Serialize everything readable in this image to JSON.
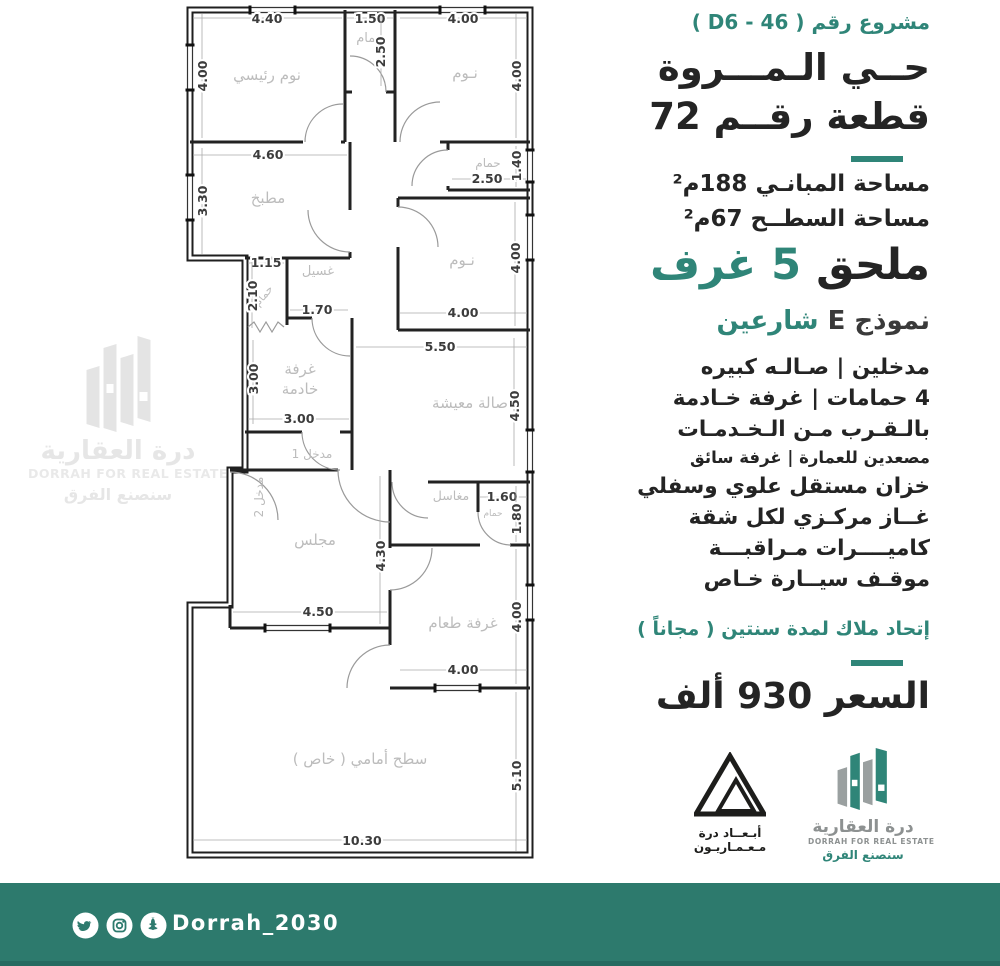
{
  "colors": {
    "accent": "#2f8578",
    "footer_bg": "#2d7a6d",
    "wall": "#1f1f1f",
    "room_label": "#bcbcbc",
    "dim_label": "#3c3c3c"
  },
  "header": {
    "project_label": "مشروع رقم",
    "project_code": "( D6 - 46 )",
    "district": "حــي الـمـــروة",
    "plot": "قطعة رقــم 72"
  },
  "specs": {
    "building_area": "مساحة المبانـي 188م²",
    "roof_area": "مساحة السطــح 67م²"
  },
  "annex": {
    "black": "ملحق",
    "teal": "5 غرف"
  },
  "model": {
    "dark": "نموذج E",
    "teal": "شارعين"
  },
  "features": [
    {
      "text": "مدخلين   |   صـالـه كبيره",
      "cls": "lg"
    },
    {
      "text": "4 حمامات | غرفة خـادمة",
      "cls": "lg"
    },
    {
      "text": "بالـقـرب مـن الـخـدمـات",
      "cls": "lg"
    },
    {
      "text": "مصعدين للعمارة | غرفة سائق",
      "cls": "md"
    },
    {
      "text": "خزان مستقل علوي وسفلي",
      "cls": "lg"
    },
    {
      "text": "غــاز مركـزي لكل شقة",
      "cls": "lg"
    },
    {
      "text": "كاميــــرات مـراقبـــة",
      "cls": "lg"
    },
    {
      "text": "موقـف سيــارة خـاص",
      "cls": "lg"
    }
  ],
  "union_note": "إتحاد ملاك لمدة سنتين ( مجاناً )",
  "price": "السعر  930  ألف",
  "logos": {
    "abaad": {
      "line1": "أبـعــاد درة",
      "line2": "مـعـمـاريـون"
    },
    "dorrah": {
      "ar": "درة العقارية",
      "en": "DORRAH FOR REAL ESTATE",
      "slogan": "سنصنع الفرق"
    }
  },
  "watermark": {
    "ar": "درة العقارية",
    "en": "DORRAH FOR REAL ESTATE",
    "slogan": "سنصنع الفرق"
  },
  "footer": {
    "handle": "Dorrah_2030",
    "icons": [
      "twitter-icon",
      "instagram-icon",
      "snapchat-icon"
    ]
  },
  "plan": {
    "rooms": [
      {
        "t": "نوم رئيسي",
        "x": 267,
        "y": 80
      },
      {
        "t": "حمام",
        "x": 370,
        "y": 42,
        "s": 13
      },
      {
        "t": "نـوم",
        "x": 465,
        "y": 78
      },
      {
        "t": "مطبخ",
        "x": 268,
        "y": 203
      },
      {
        "t": "حمام",
        "x": 488,
        "y": 167,
        "s": 12
      },
      {
        "t": "نـوم",
        "x": 462,
        "y": 265
      },
      {
        "t": "غسيل",
        "x": 318,
        "y": 275,
        "s": 13
      },
      {
        "t": "حمام",
        "x": 266,
        "y": 298,
        "s": 11,
        "rot": -50
      },
      {
        "t": "غرفة",
        "x": 300,
        "y": 374
      },
      {
        "t": "خادمة",
        "x": 300,
        "y": 394
      },
      {
        "t": "صالة معيشة",
        "x": 470,
        "y": 408
      },
      {
        "t": "مدخل 1",
        "x": 312,
        "y": 458,
        "s": 12,
        "c": "#4a4a4a"
      },
      {
        "t": "مدخل 2",
        "x": 263,
        "y": 497,
        "s": 12,
        "c": "#4a4a4a",
        "rot": -90
      },
      {
        "t": "مجلس",
        "x": 315,
        "y": 545
      },
      {
        "t": "مغاسل",
        "x": 451,
        "y": 500,
        "s": 12.5
      },
      {
        "t": "حمام",
        "x": 493,
        "y": 516,
        "s": 9,
        "c": "#a3a04e"
      },
      {
        "t": "غرفة طعام",
        "x": 463,
        "y": 628
      },
      {
        "t": "سطح أمامي ( خاص )",
        "x": 360,
        "y": 764,
        "s": 15
      }
    ],
    "dims": [
      {
        "t": "4.40",
        "x": 267,
        "y": 23,
        "l": [
          193,
          18,
          342,
          18
        ]
      },
      {
        "t": "4.00",
        "x": 207,
        "y": 76,
        "r": 1,
        "l": [
          202,
          14,
          202,
          138
        ]
      },
      {
        "t": "1.50",
        "x": 370,
        "y": 23,
        "l": [
          347,
          18,
          393,
          18
        ]
      },
      {
        "t": "2.50",
        "x": 385,
        "y": 52,
        "r": 1,
        "l": [
          381,
          16,
          381,
          86
        ]
      },
      {
        "t": "4.00",
        "x": 463,
        "y": 23,
        "l": [
          400,
          18,
          527,
          18
        ]
      },
      {
        "t": "4.00",
        "x": 521,
        "y": 76,
        "r": 1,
        "l": [
          516,
          14,
          516,
          138
        ]
      },
      {
        "t": "4.60",
        "x": 268,
        "y": 159,
        "l": [
          193,
          155,
          347,
          155
        ]
      },
      {
        "t": "3.30",
        "x": 207,
        "y": 201,
        "r": 1,
        "l": [
          202,
          148,
          202,
          254
        ]
      },
      {
        "t": "2.50",
        "x": 487,
        "y": 183,
        "l": [
          452,
          179,
          526,
          179
        ]
      },
      {
        "t": "1.40",
        "x": 521,
        "y": 166,
        "r": 1,
        "l": [
          516,
          146,
          516,
          187
        ]
      },
      {
        "t": "1.15",
        "x": 266,
        "y": 267,
        "l": [
          248,
          263,
          284,
          263
        ]
      },
      {
        "t": "2.10",
        "x": 257,
        "y": 296,
        "r": 1,
        "l": [
          252,
          262,
          252,
          328
        ]
      },
      {
        "t": "1.70",
        "x": 317,
        "y": 314,
        "l": [
          290,
          310,
          348,
          310
        ]
      },
      {
        "t": "3.00",
        "x": 258,
        "y": 379,
        "r": 1,
        "l": [
          253,
          340,
          253,
          424
        ]
      },
      {
        "t": "3.00",
        "x": 299,
        "y": 423,
        "l": [
          248,
          419,
          349,
          419
        ]
      },
      {
        "t": "4.00",
        "x": 463,
        "y": 317,
        "l": [
          400,
          313,
          527,
          313
        ]
      },
      {
        "t": "4.00",
        "x": 520,
        "y": 258,
        "r": 1,
        "l": [
          515,
          202,
          515,
          326
        ]
      },
      {
        "t": "5.50",
        "x": 440,
        "y": 351,
        "l": [
          356,
          347,
          527,
          347
        ]
      },
      {
        "t": "4.50",
        "x": 519,
        "y": 406,
        "r": 1,
        "l": [
          514,
          338,
          514,
          466
        ]
      },
      {
        "t": "4.30",
        "x": 385,
        "y": 556,
        "r": 1,
        "l": [
          380,
          476,
          380,
          624
        ]
      },
      {
        "t": "4.50",
        "x": 318,
        "y": 616,
        "l": [
          233,
          612,
          387,
          612
        ]
      },
      {
        "t": "1.60",
        "x": 502,
        "y": 501,
        "l": [
          480,
          497,
          527,
          497
        ]
      },
      {
        "t": "1.80",
        "x": 521,
        "y": 519,
        "r": 1,
        "l": [
          516,
          486,
          516,
          542
        ]
      },
      {
        "t": "4.00",
        "x": 521,
        "y": 617,
        "r": 1,
        "l": [
          516,
          549,
          516,
          684
        ]
      },
      {
        "t": "4.00",
        "x": 463,
        "y": 674,
        "l": [
          400,
          670,
          527,
          670
        ]
      },
      {
        "t": "10.30",
        "x": 362,
        "y": 845,
        "l": [
          193,
          840,
          527,
          840
        ]
      },
      {
        "t": "5.10",
        "x": 521,
        "y": 776,
        "r": 1,
        "l": [
          516,
          692,
          516,
          851
        ]
      }
    ]
  }
}
